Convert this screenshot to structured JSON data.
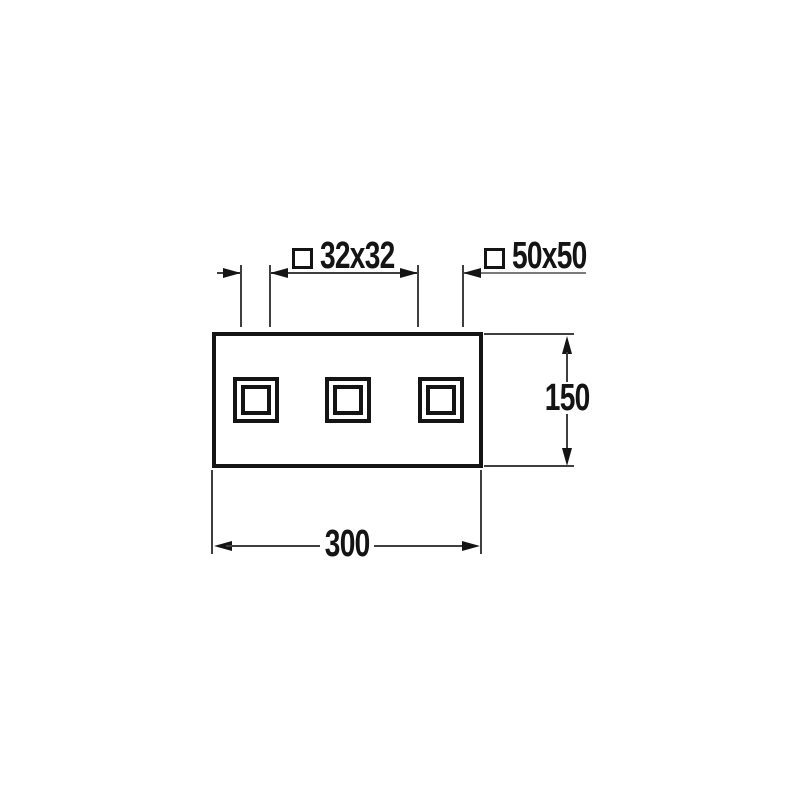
{
  "diagram": {
    "background": "#ffffff",
    "ink_color": "#141414",
    "annotations": {
      "square_symbol": "□",
      "inner_square_label": "32x32",
      "outer_square_label": "50x50",
      "height_label": "150",
      "width_label": "300"
    }
  }
}
